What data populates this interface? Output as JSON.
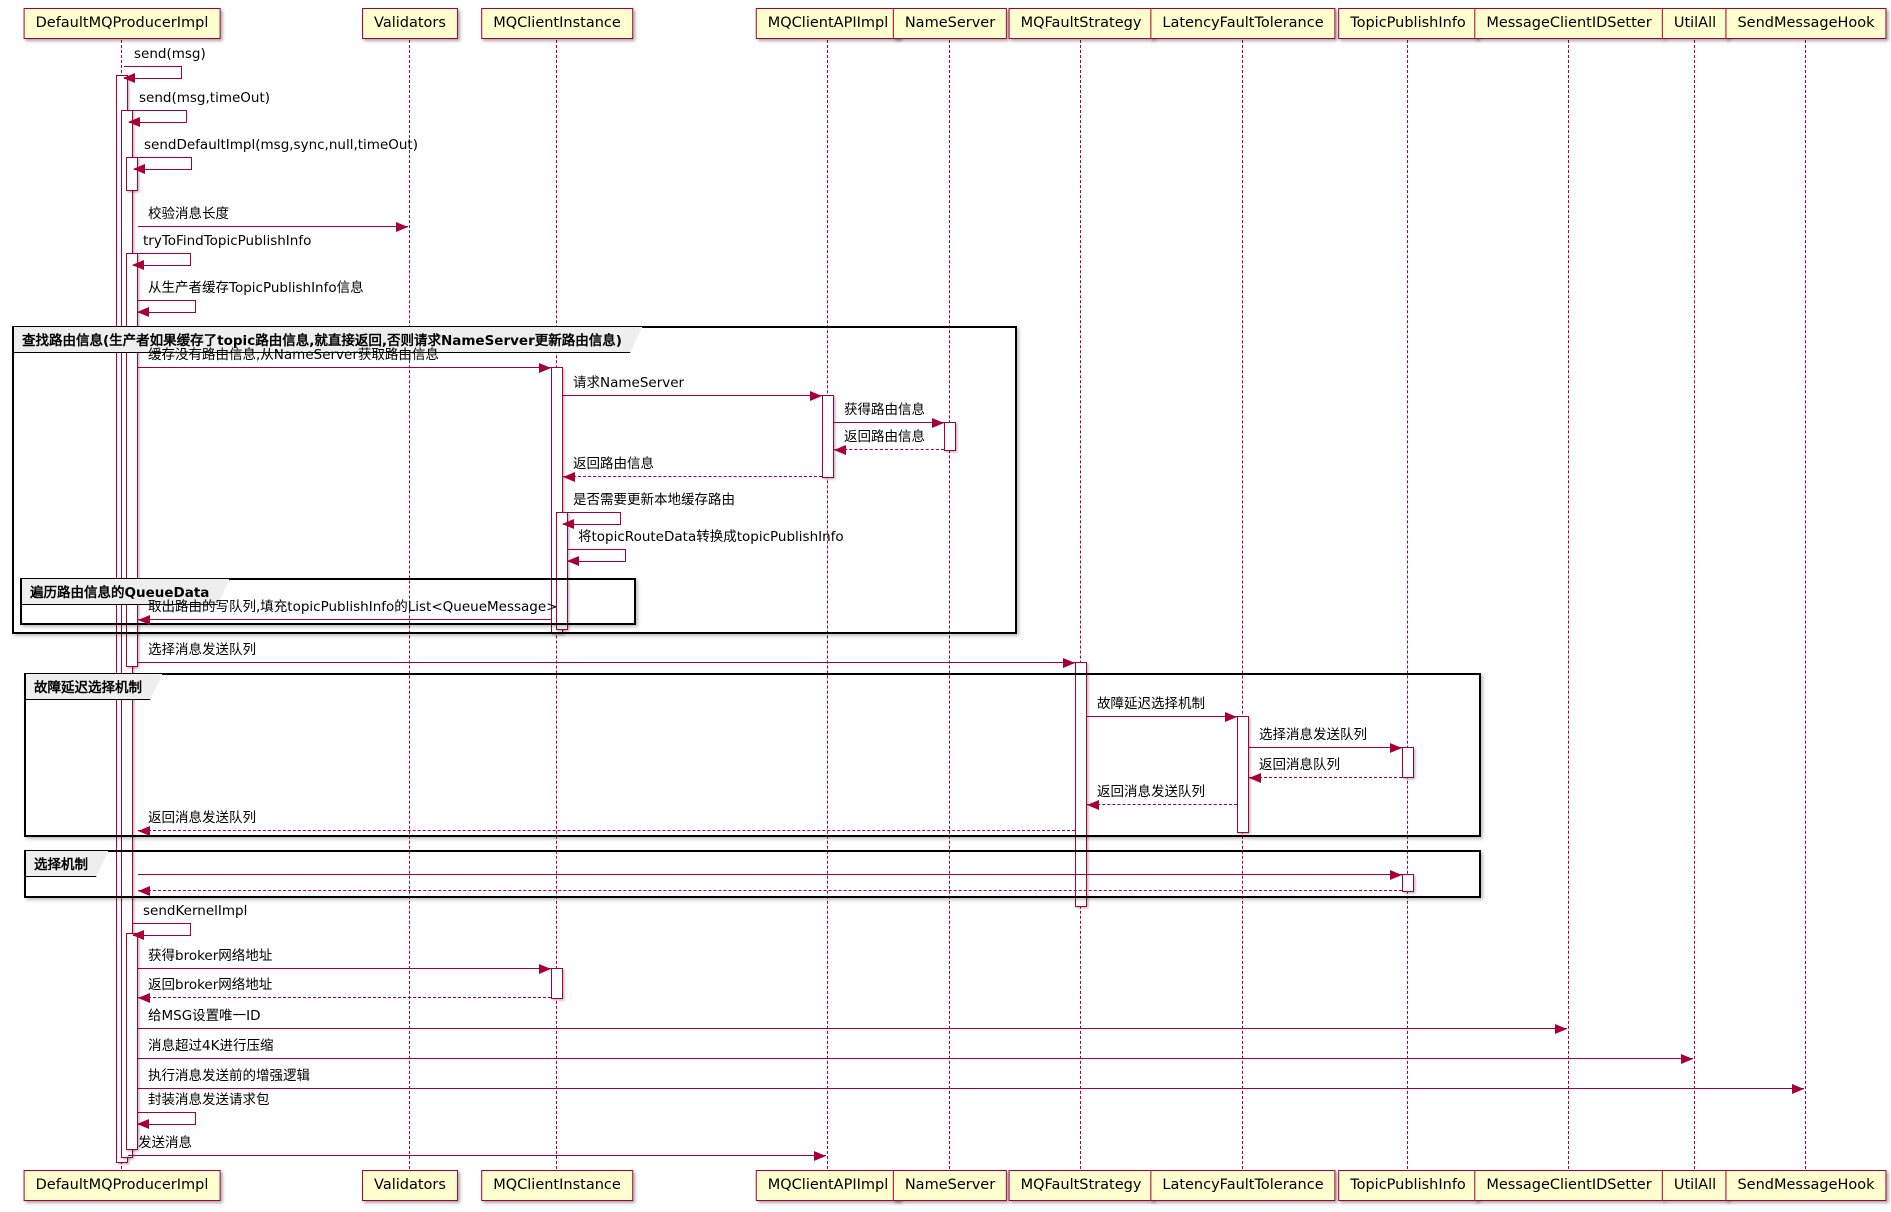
{
  "colors": {
    "accent": "#A80036",
    "participant_fill": "#FEFECE",
    "frame_border": "#000000",
    "tab_fill": "#EEEEEE",
    "background": "#FFFFFF",
    "text": "#000000"
  },
  "participants": [
    {
      "label": "DefaultMQProducerImpl",
      "x": 122
    },
    {
      "label": "Validators",
      "x": 410
    },
    {
      "label": "MQClientInstance",
      "x": 557
    },
    {
      "label": "MQClientAPIImpl",
      "x": 828
    },
    {
      "label": "NameServer",
      "x": 950
    },
    {
      "label": "MQFaultStrategy",
      "x": 1081
    },
    {
      "label": "LatencyFaultTolerance",
      "x": 1243
    },
    {
      "label": "TopicPublishInfo",
      "x": 1408
    },
    {
      "label": "MessageClientIDSetter",
      "x": 1569
    },
    {
      "label": "UtilAll",
      "x": 1695
    },
    {
      "label": "SendMessageHook",
      "x": 1806
    }
  ],
  "groups": [
    {
      "title": "查找路由信息(生产者如果缓存了topic路由信息,就直接返回,否则请求NameServer更新路由信息)",
      "x": 12,
      "y": 326,
      "w": 1005,
      "h": 308
    },
    {
      "title": "遍历路由信息的QueueData",
      "x": 20,
      "y": 578,
      "w": 616,
      "h": 47
    },
    {
      "title": "故障延迟选择机制",
      "x": 24,
      "y": 673,
      "w": 1457,
      "h": 164
    },
    {
      "title": "选择机制",
      "x": 24,
      "y": 850,
      "w": 1457,
      "h": 48
    }
  ],
  "activations": [
    {
      "x": 116,
      "y1": 75,
      "y2": 1163
    },
    {
      "x": 121,
      "y1": 110,
      "y2": 1158
    },
    {
      "x": 126,
      "y1": 157,
      "y2": 191
    },
    {
      "x": 126,
      "y1": 253,
      "y2": 667
    },
    {
      "x": 126,
      "y1": 933,
      "y2": 1150
    },
    {
      "x": 551,
      "y1": 367,
      "y2": 634
    },
    {
      "x": 556,
      "y1": 512,
      "y2": 630
    },
    {
      "x": 551,
      "y1": 968,
      "y2": 999
    },
    {
      "x": 822,
      "y1": 395,
      "y2": 478
    },
    {
      "x": 944,
      "y1": 422,
      "y2": 451
    },
    {
      "x": 1075,
      "y1": 662,
      "y2": 907
    },
    {
      "x": 1237,
      "y1": 716,
      "y2": 833
    },
    {
      "x": 1402,
      "y1": 747,
      "y2": 778
    },
    {
      "x": 1402,
      "y1": 874,
      "y2": 892
    }
  ],
  "messages": [
    {
      "type": "self",
      "label": "send(msg)",
      "x": 124,
      "y": 66
    },
    {
      "type": "self",
      "label": "send(msg,timeOut)",
      "x": 129,
      "y": 110
    },
    {
      "type": "self",
      "label": "sendDefaultImpl(msg,sync,null,timeOut)",
      "x": 134,
      "y": 157
    },
    {
      "type": "solid",
      "label": "校验消息长度",
      "x1": 138,
      "x2": 408,
      "y": 226
    },
    {
      "type": "self",
      "label": "tryToFindTopicPublishInfo",
      "x": 133,
      "y": 253
    },
    {
      "type": "self",
      "label": "从生产者缓存TopicPublishInfo信息",
      "x": 138,
      "y": 300
    },
    {
      "type": "solid",
      "label": "缓存没有路由信息,从NameServer获取路由信息",
      "x1": 138,
      "x2": 551,
      "y": 367
    },
    {
      "type": "solid",
      "label": "请求NameServer",
      "x1": 563,
      "x2": 822,
      "y": 395
    },
    {
      "type": "solid",
      "label": "获得路由信息",
      "x1": 834,
      "x2": 944,
      "y": 422
    },
    {
      "type": "dashed",
      "label": "返回路由信息",
      "x1": 944,
      "x2": 834,
      "y": 449
    },
    {
      "type": "dashed",
      "label": "返回路由信息",
      "x1": 822,
      "x2": 563,
      "y": 476
    },
    {
      "type": "self",
      "label": "是否需要更新本地缓存路由",
      "x": 563,
      "y": 512
    },
    {
      "type": "self",
      "label": "将topicRouteData转换成topicPublishInfo",
      "x": 568,
      "y": 549
    },
    {
      "type": "solid",
      "label": "取出路由的写队列,填充topicPublishInfo的List<QueueMessage>",
      "x1": 551,
      "x2": 138,
      "y": 619
    },
    {
      "type": "solid",
      "label": "选择消息发送队列",
      "x1": 138,
      "x2": 1075,
      "y": 662
    },
    {
      "type": "solid",
      "label": "故障延迟选择机制",
      "x1": 1087,
      "x2": 1237,
      "y": 716
    },
    {
      "type": "solid",
      "label": "选择消息发送队列",
      "x1": 1249,
      "x2": 1402,
      "y": 747
    },
    {
      "type": "dashed",
      "label": "返回消息队列",
      "x1": 1402,
      "x2": 1249,
      "y": 777
    },
    {
      "type": "dashed",
      "label": "返回消息发送队列",
      "x1": 1237,
      "x2": 1087,
      "y": 804
    },
    {
      "type": "dashed",
      "label": "返回消息发送队列",
      "x1": 1075,
      "x2": 138,
      "y": 830
    },
    {
      "type": "solid",
      "label": "",
      "x1": 138,
      "x2": 1402,
      "y": 874
    },
    {
      "type": "dashed",
      "label": "",
      "x1": 1402,
      "x2": 138,
      "y": 890
    },
    {
      "type": "self",
      "label": "sendKernelImpl",
      "x": 133,
      "y": 923
    },
    {
      "type": "solid",
      "label": "获得broker网络地址",
      "x1": 138,
      "x2": 551,
      "y": 968
    },
    {
      "type": "dashed",
      "label": "返回broker网络地址",
      "x1": 551,
      "x2": 138,
      "y": 997
    },
    {
      "type": "solid",
      "label": "给MSG设置唯一ID",
      "x1": 138,
      "x2": 1567,
      "y": 1028
    },
    {
      "type": "solid",
      "label": "消息超过4K进行压缩",
      "x1": 138,
      "x2": 1693,
      "y": 1058
    },
    {
      "type": "solid",
      "label": "执行消息发送前的增强逻辑",
      "x1": 138,
      "x2": 1804,
      "y": 1088
    },
    {
      "type": "self",
      "label": "封装消息发送请求包",
      "x": 138,
      "y": 1112
    },
    {
      "type": "solid",
      "label": "发送消息",
      "x1": 128,
      "x2": 826,
      "y": 1155
    }
  ]
}
